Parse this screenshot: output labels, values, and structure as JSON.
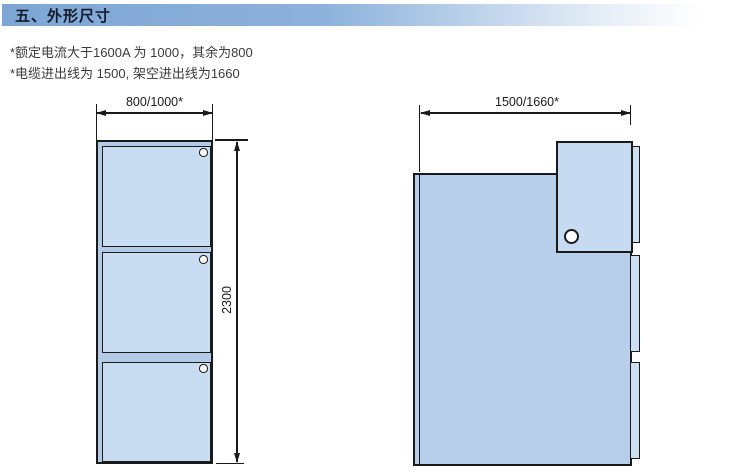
{
  "header": {
    "title": "五、外形尺寸"
  },
  "notes": {
    "line1": "*额定电流大于1600A 为 1000，其余为800",
    "line2": "*电缆进出线为 1500, 架空进出线为1660"
  },
  "front_view": {
    "width_label": "800/1000*",
    "height_label": "2300",
    "door_count": 3
  },
  "side_view": {
    "depth_label": "1500/1660*"
  },
  "colors": {
    "outline": "#1a1a1a",
    "frame_fill": "#b3cbe7",
    "door_fill": "#c9ddf2",
    "body_fill": "#b7cfea",
    "side_panel_fill": "#c6dbf1",
    "strip_fill": "#cde0f3",
    "header_bar_blue": "#7da6d4"
  }
}
